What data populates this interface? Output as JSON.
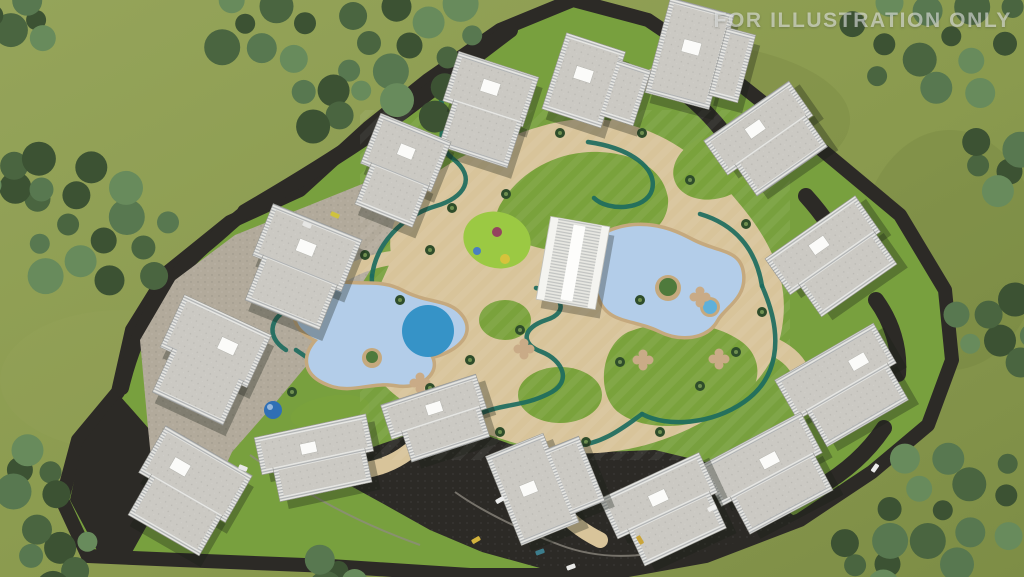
{
  "watermark": {
    "text": "FOR ILLUSTRATION ONLY"
  },
  "scene": {
    "palette": {
      "grass_outer": "#8d9c50",
      "grass_shade": "#7e8f46",
      "lawn": "#7aa23c",
      "lawn_bright": "#9bc943",
      "asphalt": "#2c2a26",
      "sand": "#d8c49a",
      "sand_deep": "#c5a97e",
      "hardscape": "#b2aa9b",
      "pool_light": "#b3cde9",
      "pool_deep": "#2f8fc5",
      "track": "#1d6b5e",
      "wall": "#e8e8e4",
      "roof": "#cbc9c3",
      "roof_box": "#fbfbf9",
      "curb": "#8f8b81",
      "dome": "#2f6fb5",
      "island_green": "#4f7a3c",
      "watermark": "rgba(240,242,244,0.55)",
      "tree_shades": [
        "#3c5233",
        "#4a6540",
        "#587850",
        "#688b5c"
      ]
    },
    "trees": [
      {
        "cx": 25,
        "cy": 20,
        "r": 35,
        "n": 5
      },
      {
        "cx": 95,
        "cy": 230,
        "r": 85,
        "n": 14
      },
      {
        "cx": 20,
        "cy": 180,
        "r": 35,
        "n": 5
      },
      {
        "cx": 260,
        "cy": 22,
        "r": 60,
        "n": 8
      },
      {
        "cx": 420,
        "cy": 55,
        "r": 85,
        "n": 14
      },
      {
        "cx": 330,
        "cy": 100,
        "r": 40,
        "n": 5
      },
      {
        "cx": 935,
        "cy": 40,
        "r": 90,
        "n": 14
      },
      {
        "cx": 1000,
        "cy": 165,
        "r": 40,
        "n": 5
      },
      {
        "cx": 1002,
        "cy": 330,
        "r": 55,
        "n": 8
      },
      {
        "cx": 958,
        "cy": 505,
        "r": 88,
        "n": 14
      },
      {
        "cx": 30,
        "cy": 475,
        "r": 38,
        "n": 5
      },
      {
        "cx": 60,
        "cy": 558,
        "r": 45,
        "n": 6
      },
      {
        "cx": 330,
        "cy": 575,
        "r": 28,
        "n": 4
      },
      {
        "cx": 876,
        "cy": 560,
        "r": 40,
        "n": 5
      }
    ],
    "buildings": [
      {
        "name": "apartment-block-1",
        "cx": 484,
        "cy": 110,
        "rot": 18,
        "parts": [
          [
            -42,
            -48,
            84,
            52
          ],
          [
            -32,
            -4,
            72,
            52
          ]
        ],
        "box": [
          -10,
          -30,
          18,
          13
        ]
      },
      {
        "name": "apartment-block-2",
        "cx": 598,
        "cy": 85,
        "rot": 18,
        "parts": [
          [
            -46,
            -40,
            62,
            80
          ],
          [
            10,
            -30,
            36,
            58
          ]
        ],
        "box": [
          -26,
          -12,
          18,
          13
        ]
      },
      {
        "name": "apartment-block-3",
        "cx": 702,
        "cy": 58,
        "rot": 15,
        "parts": [
          [
            -46,
            -50,
            66,
            98
          ],
          [
            16,
            -36,
            30,
            70
          ]
        ],
        "box": [
          -22,
          -14,
          18,
          13
        ]
      },
      {
        "name": "apartment-block-4",
        "cx": 398,
        "cy": 172,
        "rot": 22,
        "parts": [
          [
            -38,
            -48,
            76,
            54
          ],
          [
            -28,
            -2,
            62,
            48
          ]
        ],
        "box": [
          -8,
          -28,
          16,
          12
        ]
      },
      {
        "name": "apartment-block-5",
        "cx": 299,
        "cy": 268,
        "rot": 22,
        "parts": [
          [
            -48,
            -50,
            96,
            56
          ],
          [
            -38,
            -2,
            80,
            52
          ]
        ],
        "box": [
          -10,
          -28,
          18,
          13
        ]
      },
      {
        "name": "apartment-block-6",
        "cx": 768,
        "cy": 142,
        "rot": -35,
        "parts": [
          [
            -52,
            -38,
            104,
            42
          ],
          [
            -40,
            -4,
            86,
            42
          ]
        ],
        "box": [
          -12,
          -24,
          18,
          12
        ]
      },
      {
        "name": "apartment-block-7",
        "cx": 833,
        "cy": 260,
        "rot": -35,
        "parts": [
          [
            -55,
            -40,
            110,
            44
          ],
          [
            -42,
            -2,
            92,
            42
          ]
        ],
        "box": [
          -12,
          -26,
          18,
          12
        ]
      },
      {
        "name": "apartment-block-8",
        "cx": 845,
        "cy": 388,
        "rot": -30,
        "parts": [
          [
            -57,
            -42,
            114,
            46
          ],
          [
            -45,
            -2,
            94,
            44
          ]
        ],
        "box": [
          16,
          -22,
          18,
          12
        ]
      },
      {
        "name": "apartment-block-9",
        "cx": 770,
        "cy": 476,
        "rot": -28,
        "parts": [
          [
            -57,
            -42,
            114,
            46
          ],
          [
            -45,
            -2,
            94,
            44
          ]
        ],
        "box": [
          -2,
          -20,
          18,
          12
        ]
      },
      {
        "name": "apartment-block-10",
        "cx": 666,
        "cy": 512,
        "rot": -25,
        "parts": [
          [
            -55,
            -40,
            110,
            44
          ],
          [
            -42,
            -2,
            90,
            42
          ]
        ],
        "box": [
          -10,
          -22,
          18,
          12
        ]
      },
      {
        "name": "apartment-block-11",
        "cx": 548,
        "cy": 483,
        "rot": -22,
        "parts": [
          [
            -48,
            -48,
            62,
            96
          ],
          [
            8,
            -32,
            38,
            70
          ]
        ],
        "box": [
          -28,
          -8,
          16,
          12
        ]
      },
      {
        "name": "apartment-block-12",
        "cx": 438,
        "cy": 420,
        "rot": -18,
        "parts": [
          [
            -50,
            -32,
            100,
            36
          ],
          [
            -38,
            -4,
            82,
            36
          ]
        ],
        "box": [
          -8,
          -18,
          16,
          11
        ]
      },
      {
        "name": "apartment-block-13",
        "cx": 317,
        "cy": 459,
        "rot": -12,
        "parts": [
          [
            -57,
            -34,
            114,
            38
          ],
          [
            -45,
            -2,
            94,
            36
          ]
        ],
        "box": [
          -14,
          -18,
          16,
          11
        ]
      },
      {
        "name": "apartment-block-14",
        "cx": 206,
        "cy": 362,
        "rot": 25,
        "parts": [
          [
            -48,
            -52,
            96,
            58
          ],
          [
            -36,
            -4,
            78,
            54
          ]
        ],
        "box": [
          4,
          -30,
          18,
          13
        ]
      },
      {
        "name": "apartment-block-15",
        "cx": 184,
        "cy": 494,
        "rot": 30,
        "parts": [
          [
            -50,
            -50,
            100,
            54
          ],
          [
            -38,
            -4,
            82,
            50
          ]
        ],
        "box": [
          -26,
          -28,
          18,
          13
        ]
      }
    ],
    "cars": [
      {
        "x": 500,
        "y": 500,
        "rot": -30,
        "c": "#eceded"
      },
      {
        "x": 476,
        "y": 540,
        "rot": -30,
        "c": "#d3b33c"
      },
      {
        "x": 540,
        "y": 552,
        "rot": -20,
        "c": "#3d7d8c"
      },
      {
        "x": 571,
        "y": 567,
        "rot": -20,
        "c": "#e9e9e7"
      },
      {
        "x": 640,
        "y": 540,
        "rot": 60,
        "c": "#caa53a"
      },
      {
        "x": 712,
        "y": 508,
        "rot": -30,
        "c": "#f0f0ee"
      },
      {
        "x": 875,
        "y": 468,
        "rot": -55,
        "c": "#ebebe9"
      },
      {
        "x": 243,
        "y": 468,
        "rot": 22,
        "c": "#e8e8e6"
      },
      {
        "x": 335,
        "y": 215,
        "rot": 24,
        "c": "#cfc23e"
      },
      {
        "x": 307,
        "y": 225,
        "rot": 24,
        "c": "#e6e6e4"
      }
    ],
    "palms": [
      [
        400,
        300
      ],
      [
        365,
        255
      ],
      [
        452,
        208
      ],
      [
        506,
        194
      ],
      [
        560,
        133
      ],
      [
        642,
        133
      ],
      [
        690,
        180
      ],
      [
        746,
        224
      ],
      [
        762,
        312
      ],
      [
        736,
        352
      ],
      [
        700,
        386
      ],
      [
        640,
        300
      ],
      [
        620,
        362
      ],
      [
        520,
        330
      ],
      [
        470,
        360
      ],
      [
        430,
        388
      ],
      [
        500,
        432
      ],
      [
        586,
        442
      ],
      [
        660,
        432
      ],
      [
        352,
        430
      ],
      [
        292,
        392
      ],
      [
        560,
        232
      ],
      [
        618,
        68
      ],
      [
        430,
        250
      ]
    ],
    "planters": [
      [
        420,
        383
      ],
      [
        643,
        360
      ],
      [
        719,
        359
      ],
      [
        700,
        297
      ],
      [
        524,
        349
      ]
    ],
    "playground_dots": [
      {
        "x": 497,
        "y": 232,
        "r": 5,
        "c": "#94445f"
      },
      {
        "x": 477,
        "y": 251,
        "r": 4,
        "c": "#4a7fc1"
      },
      {
        "x": 505,
        "y": 259,
        "r": 5,
        "c": "#d6c33c"
      }
    ]
  }
}
